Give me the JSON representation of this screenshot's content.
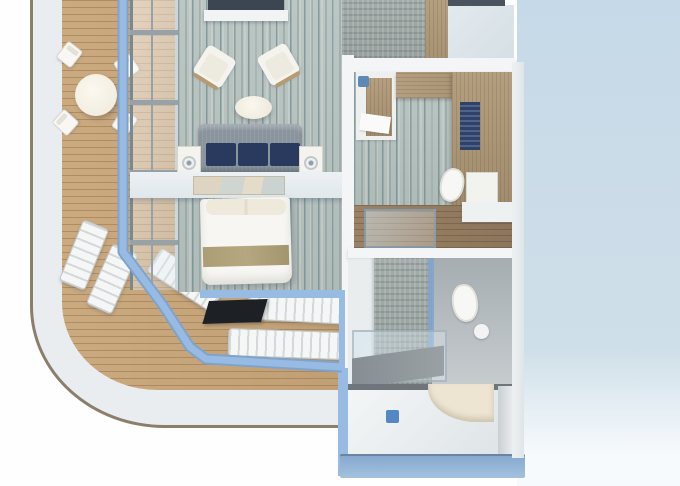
{
  "scene": {
    "type": "3d-floorplan-render",
    "subject": "Top-down 3D cutaway rendering of a cruise ship suite with wraparound balcony",
    "areas": [
      {
        "name": "wraparound-balcony",
        "items": [
          "white hull band with tan edge",
          "teak plank deck",
          "round dining table",
          "four folding deck chairs",
          "two angled sun loungers",
          "three flat sun loungers",
          "dark deck panel",
          "light-blue glass balustrade frame"
        ]
      },
      {
        "name": "living-room",
        "items": [
          "teal striped carpet",
          "wall tv slab",
          "white media shelf",
          "two white armchairs",
          "white oval coffee table",
          "grey sofa with three navy cushions",
          "two white side tables with round lamps",
          "white console with framed artwork"
        ]
      },
      {
        "name": "bedroom-area",
        "items": [
          "double bed with white duvet",
          "cream pillows",
          "beige bed runner"
        ]
      },
      {
        "name": "entry-hall",
        "items": [
          "grey mosaic floor",
          "wood wall panel",
          "pale counter top",
          "dark wall cap"
        ]
      },
      {
        "name": "dressing-room",
        "items": [
          "white desk with wood front",
          "blue stool",
          "wood wardrobe L-unit",
          "navy slatted shelves",
          "toilet",
          "white cabinet"
        ]
      },
      {
        "name": "shower-room",
        "items": [
          "wood plank floor",
          "glass shower enclosure",
          "white counter"
        ]
      },
      {
        "name": "main-bathroom",
        "items": [
          "white door panel",
          "mosaic tiled wall",
          "blue-framed glass partition",
          "toilet",
          "round floor drain",
          "grey vanity slab",
          "grey floor"
        ]
      },
      {
        "name": "wet-room",
        "items": [
          "white shower floor",
          "blue drain square",
          "curved cream wall",
          "white side wall",
          "blue deck band"
        ]
      }
    ]
  },
  "colors": {
    "bg_left": "#fefefe",
    "bg_right_top": "#c6d9e8",
    "bg_right_mid": "#cfdfe9",
    "bg_right_bottom": "#f7fafc",
    "hull_white": "#e9edef",
    "hull_edge": "#8d7d6b",
    "deck": "#cbaa80",
    "frame_blue": "#97bbe2",
    "frame_blue_dark": "#7fa3cd",
    "carpet_base": "#bcc6c3",
    "carpet_streak": "#49767c",
    "wall_white": "#f3f5f6",
    "wood": "#b59f81",
    "wood_floor": "#9b8266",
    "mosaic_base": "#a3aca9",
    "sofa_grey": "#8a949c",
    "cushion_navy": "#2a3a5e",
    "furniture_white": "#f4f3ee",
    "console_white": "#e0e8ec",
    "bed_white": "#f7f6f2",
    "bed_runner": "#b5a77f",
    "dark_slab": "#3c4652",
    "porcelain": "#f7f7f5",
    "drain_blue": "#5587c2",
    "band_blue": "#a3c1de",
    "cream": "#ede5d2",
    "tile_floor": "#a6adb1",
    "panel_black": "#1d2125"
  }
}
